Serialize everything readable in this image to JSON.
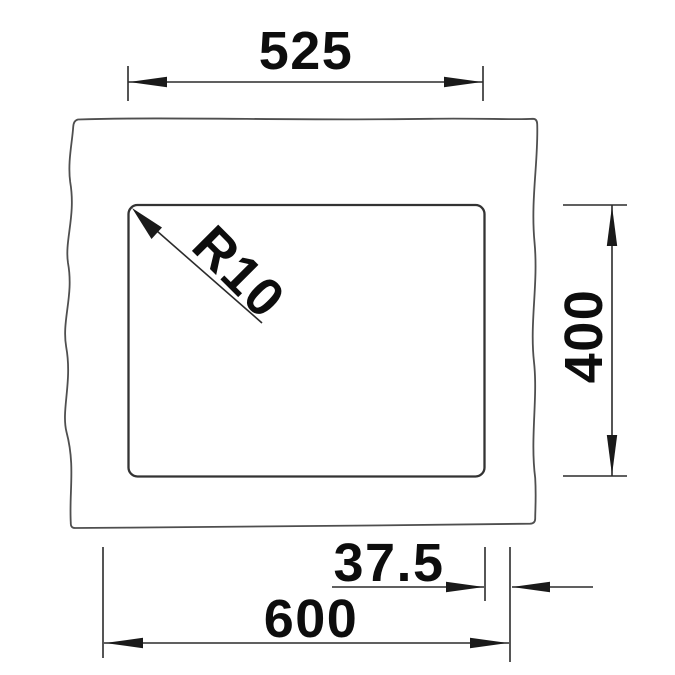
{
  "drawing": {
    "colors": {
      "background": "#ffffff",
      "countertop_outline": "#4f4f4f",
      "bowl_outline": "#333333",
      "dimension_lines": "#2b2b2b",
      "dimension_text": "#0d0d0d"
    },
    "dimensions": {
      "cutout_width": "525",
      "bowl_height": "400",
      "overall_width": "600",
      "edge_offset": "37.5",
      "corner_radius": "R10"
    }
  }
}
